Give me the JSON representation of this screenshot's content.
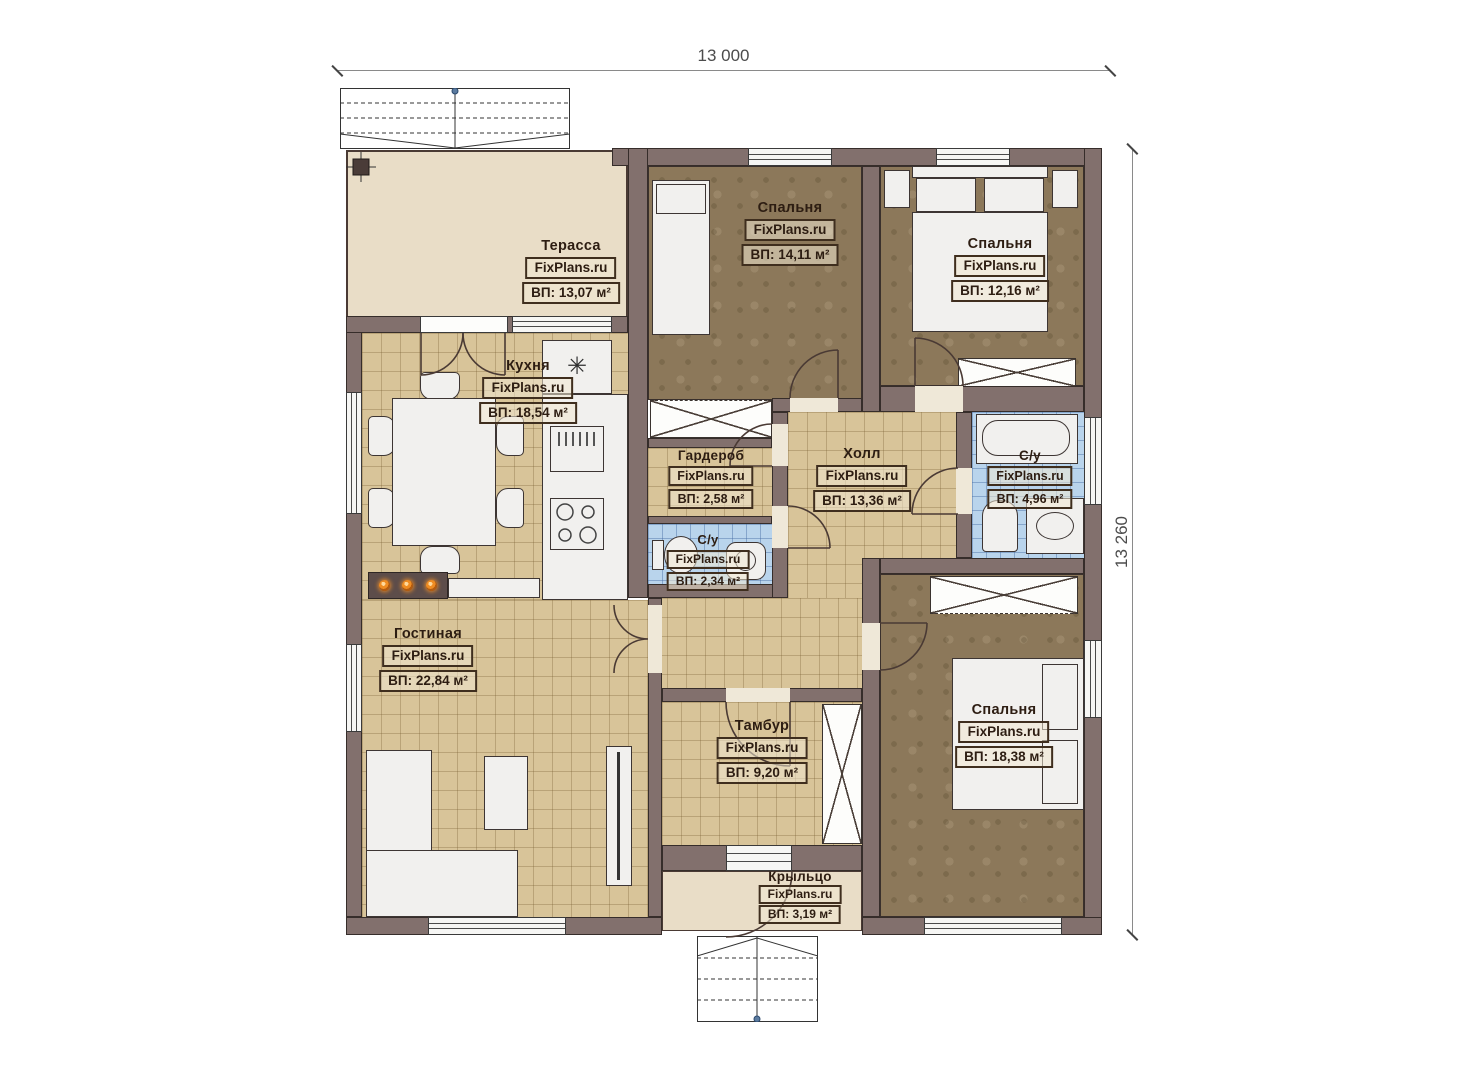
{
  "watermark": "FixPlans.ru",
  "dimensions": {
    "width_label": "13 000",
    "height_label": "13 260"
  },
  "icons": {
    "fridge": "✳"
  },
  "rooms": [
    {
      "id": "terrace",
      "name": "Терасса",
      "area": "ВП: 13,07 м²"
    },
    {
      "id": "kitchen",
      "name": "Кухня",
      "area": "ВП: 18,54 м²"
    },
    {
      "id": "bedroom1",
      "name": "Спальня",
      "area": "ВП: 14,11 м²"
    },
    {
      "id": "bedroom2",
      "name": "Спальня",
      "area": "ВП: 12,16 м²"
    },
    {
      "id": "wardrobe",
      "name": "Гардероб",
      "area": "ВП: 2,58 м²"
    },
    {
      "id": "hall",
      "name": "Холл",
      "area": "ВП: 13,36 м²"
    },
    {
      "id": "bath-big",
      "name": "С/у",
      "area": "ВП: 4,96 м²"
    },
    {
      "id": "bath-small",
      "name": "С/у",
      "area": "ВП: 2,34 м²"
    },
    {
      "id": "living",
      "name": "Гостиная",
      "area": "ВП: 22,84 м²"
    },
    {
      "id": "vestibule",
      "name": "Тамбур",
      "area": "ВП: 9,20 м²"
    },
    {
      "id": "bedroom3",
      "name": "Спальня",
      "area": "ВП: 18,38 м²"
    },
    {
      "id": "porch",
      "name": "Крыльцо",
      "area": "ВП: 3,19 м²"
    }
  ]
}
